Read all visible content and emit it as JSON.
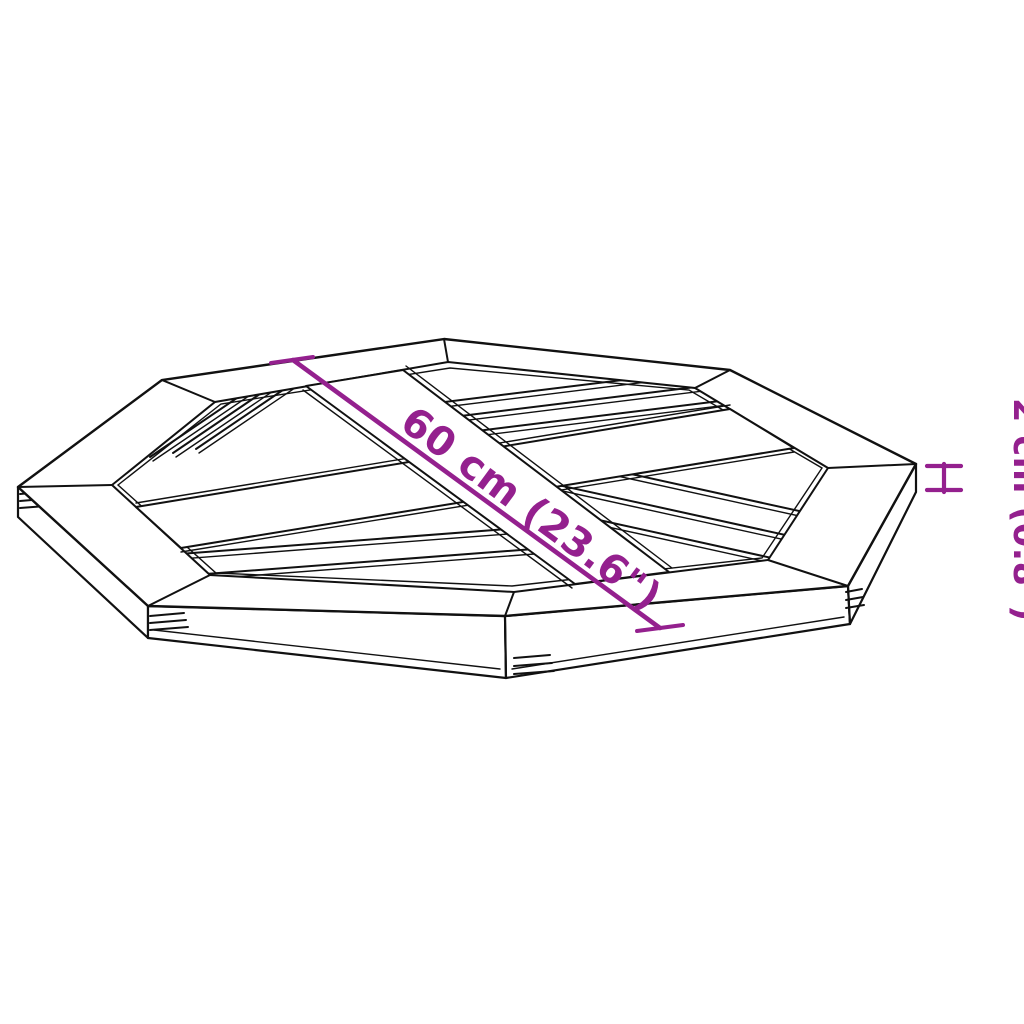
{
  "diagram": {
    "type": "product-dimension-illustration",
    "subject": "octagonal-slatted-table-top",
    "dimension_diagonal": {
      "label": "60 cm (23.6\")",
      "meaning": "width across flats of octagonal top"
    },
    "dimension_thickness": {
      "label": "2 cm (0.8\")",
      "meaning": "thickness of table top"
    },
    "icons": {
      "thickness_marker": "h-bracket-icon"
    },
    "colors": {
      "dimension": "#94208E",
      "line_art": "#111111",
      "background": "#FFFFFF"
    }
  }
}
